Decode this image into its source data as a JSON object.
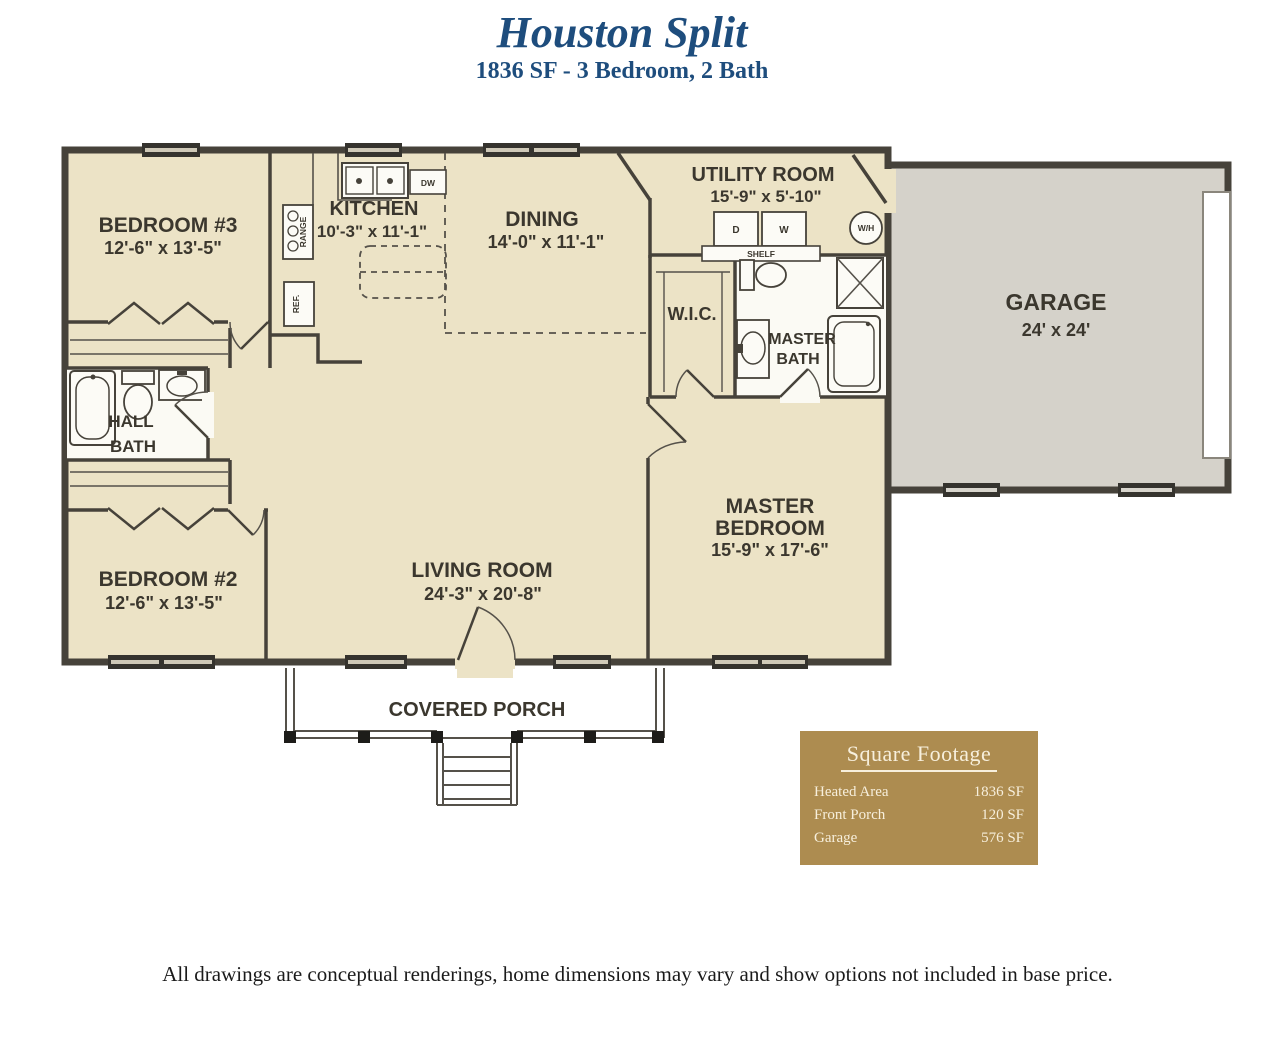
{
  "header": {
    "title": "Houston Split",
    "subtitle": "1836 SF - 3 Bedroom, 2 Bath"
  },
  "rooms": {
    "bedroom3": {
      "name": "BEDROOM #3",
      "dims": "12'-6\" x 13'-5\""
    },
    "kitchen": {
      "name": "KITCHEN",
      "dims": "10'-3\" x 11'-1\""
    },
    "dining": {
      "name": "DINING",
      "dims": "14'-0\" x 11'-1\""
    },
    "utility": {
      "name": "UTILITY ROOM",
      "dims": "15'-9\" x 5'-10\""
    },
    "garage": {
      "name": "GARAGE",
      "dims": "24' x 24'"
    },
    "wic": {
      "name": "W.I.C."
    },
    "master_bath": {
      "line1": "MASTER",
      "line2": "BATH"
    },
    "hall_bath": {
      "line1": "HALL",
      "line2": "BATH"
    },
    "bedroom2": {
      "name": "BEDROOM #2",
      "dims": "12'-6\" x 13'-5\""
    },
    "living": {
      "name": "LIVING ROOM",
      "dims": "24'-3\" x 20'-8\""
    },
    "master_bedroom": {
      "line1": "MASTER",
      "line2": "BEDROOM",
      "dims": "15'-9\" x 17'-6\""
    },
    "porch": {
      "name": "COVERED PORCH"
    }
  },
  "fixtures": {
    "dishwasher": "DW",
    "range": "RANGE",
    "refrigerator": "REF.",
    "dryer": "D",
    "washer": "W",
    "shelf": "SHELF",
    "water_heater": "W/H"
  },
  "square_footage": {
    "title": "Square Footage",
    "rows": [
      {
        "label": "Heated Area",
        "value": "1836 SF"
      },
      {
        "label": "Front Porch",
        "value": "120 SF"
      },
      {
        "label": "Garage",
        "value": "576 SF"
      }
    ]
  },
  "footer": {
    "disclaimer": "All drawings are conceptual renderings, home dimensions may vary and show options not included in base price."
  },
  "colors": {
    "title_blue": "#1e4d7d",
    "floor_cream": "#ece3c6",
    "garage_gray": "#d5d2ca",
    "wall_dark": "#46423a",
    "legend_gold": "#ad8c50"
  }
}
